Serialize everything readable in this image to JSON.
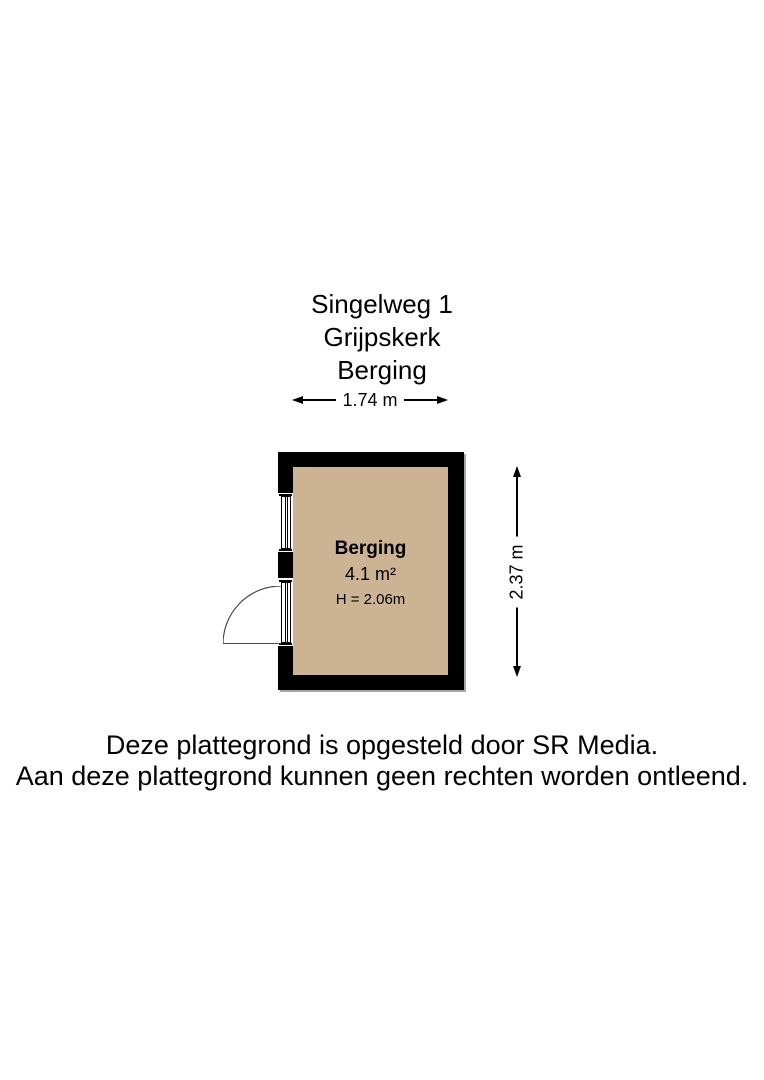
{
  "title": {
    "address": "Singelweg 1",
    "city": "Grijpskerk",
    "plan_name": "Berging"
  },
  "dimensions": {
    "width_label": "1.74 m",
    "height_label": "2.37 m"
  },
  "room": {
    "name": "Berging",
    "area": "4.1 m²",
    "ceiling_height": "H = 2.06m"
  },
  "footer": {
    "line1": "Deze plattegrond is opgesteld door SR Media.",
    "line2": "Aan deze plattegrond kunnen geen rechten worden ontleend."
  },
  "colors": {
    "wall": "#000000",
    "floor": "#cbb394",
    "line": "#000000",
    "text": "#000000",
    "door_arc": "#4a4a4a"
  }
}
